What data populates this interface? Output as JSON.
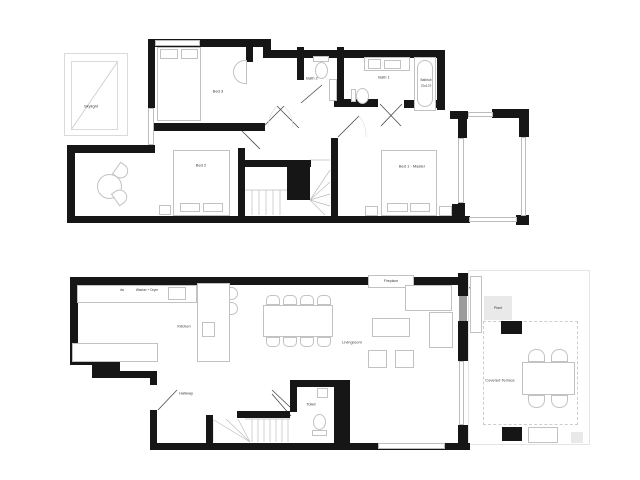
{
  "document": {
    "kind": "floor-plan-drawing",
    "background": "#ffffff"
  },
  "colors": {
    "wall": "#161616",
    "furniture_outline": "#c2c2c2",
    "label_text": "#3c3c3c",
    "door_panel_gray": "#9b9b9b",
    "plant_fill": "#e9e9e9",
    "terrace_dash": "#cdcdcd"
  },
  "upper_floor": {
    "labels": {
      "skylight": "Skylight",
      "bed3": "Bed 3",
      "bath2": "Bath 2",
      "bath1": "Bath 1",
      "bathtub_line1": "Bathtub",
      "bathtub_line2": "70x170",
      "bed2": "Bed 2",
      "bed1": "Bed 1 - Master"
    }
  },
  "lower_floor": {
    "labels": {
      "dishwasher": "dw",
      "washer_dryer": "Washer + Dryer",
      "kitchen": "Kitchen",
      "livingroom": "Livingroom",
      "hallway": "Hallway",
      "toilet": "Toilet",
      "fireplace": "Fireplace",
      "plant": "Plant",
      "terrace": "Covered Terrace"
    }
  }
}
